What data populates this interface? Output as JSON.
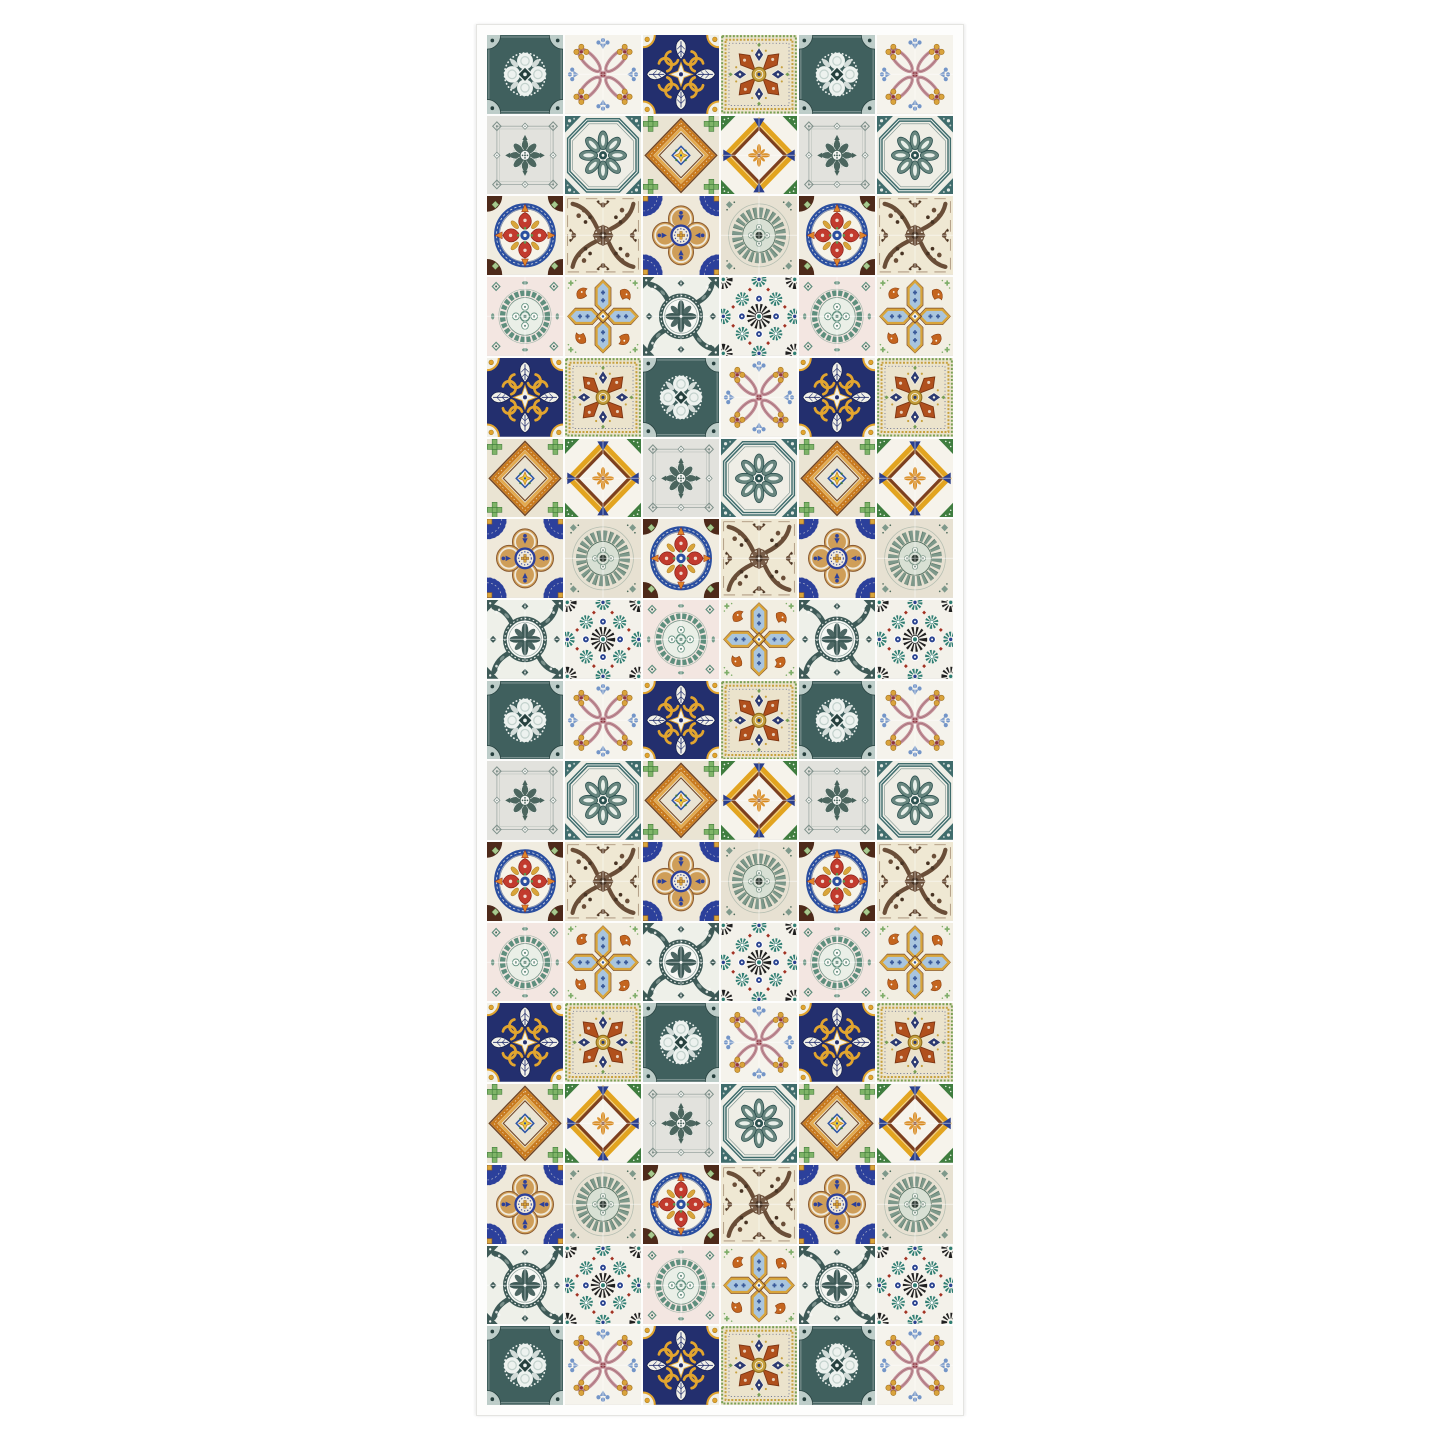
{
  "page": {
    "background_color": "#ffffff"
  },
  "poster": {
    "title": "Patchwork azulejo tile panel",
    "rows": 17,
    "cols": 6,
    "sheet_color": "#fdfdfc",
    "edge_color": "#e4e4e1",
    "grout_color": "#ffffff"
  },
  "tiles": {
    "teal-rosette": {
      "name": "dark teal ornate rosette tile",
      "quad": false,
      "palette": {
        "bg": "#40605e",
        "ink": "#edf2ef",
        "mid": "#c3d2cd",
        "dark": "#26403e"
      }
    },
    "pink-loops": {
      "name": "pink interlaced loops with gold flowers tile",
      "quad": true,
      "palette": {
        "bg": "#f5f3ec",
        "loop": "#c38f98",
        "loop_dark": "#9e6a74",
        "gold": "#daa33c",
        "gold_dark": "#a3731f",
        "blue": "#7395c8",
        "red": "#8e3540"
      }
    },
    "navy-gold-cross": {
      "name": "navy and gold scroll cross tile",
      "quad": false,
      "palette": {
        "navy": "#232f6e",
        "navy_dark": "#141e4d",
        "gold": "#e2a52f",
        "gold_dark": "#a87818",
        "ink": "#f1f0e8"
      }
    },
    "orange-star-mosaic": {
      "name": "rust star on mosaic-dot ground tile",
      "quad": false,
      "palette": {
        "bg": "#ebe3cc",
        "rust": "#b0501d",
        "rust_dark": "#7e3512",
        "navy": "#2c3a72",
        "gold": "#c6a03d",
        "gold_dark": "#8f6d1d",
        "green": "#79a054",
        "ink": "#f4f0e2"
      }
    },
    "gray-lace": {
      "name": "pale gray tile with fine green-gray medallion",
      "quad": false,
      "palette": {
        "bg": "#e2e2dd",
        "frame": "#a9b1ad",
        "orn": "#7e908a",
        "dark": "#46615a",
        "mid_bg": "#ccd2cb",
        "ink": "#f4f5f2"
      }
    },
    "teal-octagon": {
      "name": "teal octagon with eight-petal rosette tile",
      "quad": false,
      "palette": {
        "bg": "#efeee6",
        "teal": "#3f6c6c",
        "teal_dark": "#2c5150",
        "petal": "#68867f",
        "petal_lt": "#e9efe9",
        "ink": "#f7f7f2"
      }
    },
    "orange-diamond": {
      "name": "orange diamond frame with green crosses tile",
      "quad": false,
      "palette": {
        "bg": "#eae4d3",
        "or1": "#c87a1f",
        "or2": "#e2a94e",
        "brown": "#6f4527",
        "green": "#7fb468",
        "green_dark": "#3e7a39",
        "blue": "#2d55a5",
        "yellow": "#e9c93e",
        "ink": "#f4efdf"
      }
    },
    "orange-pinwheel": {
      "name": "orange and navy chevron star tile",
      "quad": true,
      "palette": {
        "bg": "#f6f3eb",
        "gold": "#e2a420",
        "brown": "#7c3f1f",
        "navy": "#2b3f8c",
        "green": "#3f7d3f",
        "orange": "#d8891e"
      }
    },
    "red-quatrefoil": {
      "name": "red quatrefoil in blue ring tile",
      "quad": false,
      "palette": {
        "bg": "#f0ece0",
        "blue": "#2b4fa0",
        "blue_dark": "#1d3572",
        "red": "#c23b2e",
        "red_dark": "#8a241c",
        "orange": "#e0862a",
        "green": "#5d9950",
        "brown": "#4e2a1a",
        "gold": "#d9a53a",
        "gold_dark": "#a3731f",
        "ltgreen": "#a9c88f",
        "ink": "#f6f3e8"
      }
    },
    "brown-damask": {
      "name": "sepia floral damask tile",
      "quad": true,
      "palette": {
        "bg": "#efe8d3",
        "sepia": "#6a4e38",
        "sepia_dk": "#483424",
        "line": "#8d7158",
        "ink": "#f6f1e2"
      }
    },
    "blue-gold-quatrefoil": {
      "name": "royal blue and tan quatrefoil tile",
      "quad": false,
      "palette": {
        "cream": "#efe9da",
        "blue": "#2c409b",
        "tan": "#cf9e58",
        "brown": "#8a5a30",
        "gold": "#d9a53a"
      }
    },
    "sage-circle": {
      "name": "sage green radial fan medallion tile",
      "quad": true,
      "palette": {
        "bg": "#e7e1d2",
        "sage": "#7e998b",
        "sage_dk": "#4d6a5b",
        "lt": "#d8e0d4",
        "ring": "#b3bdb0",
        "ink": "#2e3a33"
      }
    },
    "green-medallion": {
      "name": "teal scalloped wreath on pink tile",
      "quad": true,
      "palette": {
        "bg": "#f3e6e1",
        "teal": "#5f8f7e",
        "teal_dk": "#3c695a",
        "lt": "#e9f0e8",
        "ink": "#fbfbf7"
      }
    },
    "orange-cross-hex": {
      "name": "hexagon-arm cross with rust griffins tile",
      "quad": false,
      "palette": {
        "bg": "#f2eee2",
        "gold": "#d9a53a",
        "brown": "#7a4a28",
        "bluefill": "#a9c5de",
        "blue_dk": "#3a5a9a",
        "rust": "#c4651f",
        "rust_dk": "#8f4312",
        "green": "#7fae6a",
        "ink": "#f8f5ea"
      }
    },
    "teal-ornate-circle": {
      "name": "slate ornate circle medallion tile",
      "quad": true,
      "palette": {
        "bg": "#eef0e9",
        "slate": "#3e5a57",
        "slate_lt": "#7b918c",
        "ink": "#f7f8f4"
      }
    },
    "moorish-mosaic": {
      "name": "moorish geometric mosaic tile",
      "quad": false,
      "palette": {
        "bg": "#f3f1ea",
        "black": "#202020",
        "teal": "#2e7d72",
        "navy": "#2a4390",
        "red": "#a23122",
        "ink": "#ffffff"
      }
    }
  },
  "grid": {
    "rows": [
      [
        "teal-rosette",
        "pink-loops",
        "navy-gold-cross",
        "orange-star-mosaic",
        "teal-rosette",
        "pink-loops"
      ],
      [
        "gray-lace",
        "teal-octagon",
        "orange-diamond",
        "orange-pinwheel",
        "gray-lace",
        "teal-octagon"
      ],
      [
        "red-quatrefoil",
        "brown-damask",
        "blue-gold-quatrefoil",
        "sage-circle",
        "red-quatrefoil",
        "brown-damask"
      ],
      [
        "green-medallion",
        "orange-cross-hex",
        "teal-ornate-circle",
        "moorish-mosaic",
        "green-medallion",
        "orange-cross-hex"
      ],
      [
        "navy-gold-cross",
        "orange-star-mosaic",
        "teal-rosette",
        "pink-loops",
        "navy-gold-cross",
        "orange-star-mosaic"
      ],
      [
        "orange-diamond",
        "orange-pinwheel",
        "gray-lace",
        "teal-octagon",
        "orange-diamond",
        "orange-pinwheel"
      ],
      [
        "blue-gold-quatrefoil",
        "sage-circle",
        "red-quatrefoil",
        "brown-damask",
        "blue-gold-quatrefoil",
        "sage-circle"
      ],
      [
        "teal-ornate-circle",
        "moorish-mosaic",
        "green-medallion",
        "orange-cross-hex",
        "teal-ornate-circle",
        "moorish-mosaic"
      ],
      [
        "teal-rosette",
        "pink-loops",
        "navy-gold-cross",
        "orange-star-mosaic",
        "teal-rosette",
        "pink-loops"
      ],
      [
        "gray-lace",
        "teal-octagon",
        "orange-diamond",
        "orange-pinwheel",
        "gray-lace",
        "teal-octagon"
      ],
      [
        "red-quatrefoil",
        "brown-damask",
        "blue-gold-quatrefoil",
        "sage-circle",
        "red-quatrefoil",
        "brown-damask"
      ],
      [
        "green-medallion",
        "orange-cross-hex",
        "teal-ornate-circle",
        "moorish-mosaic",
        "green-medallion",
        "orange-cross-hex"
      ],
      [
        "navy-gold-cross",
        "orange-star-mosaic",
        "teal-rosette",
        "pink-loops",
        "navy-gold-cross",
        "orange-star-mosaic"
      ],
      [
        "orange-diamond",
        "orange-pinwheel",
        "gray-lace",
        "teal-octagon",
        "orange-diamond",
        "orange-pinwheel"
      ],
      [
        "blue-gold-quatrefoil",
        "sage-circle",
        "red-quatrefoil",
        "brown-damask",
        "blue-gold-quatrefoil",
        "sage-circle"
      ],
      [
        "teal-ornate-circle",
        "moorish-mosaic",
        "green-medallion",
        "orange-cross-hex",
        "teal-ornate-circle",
        "moorish-mosaic"
      ],
      [
        "teal-rosette",
        "pink-loops",
        "navy-gold-cross",
        "orange-star-mosaic",
        "teal-rosette",
        "pink-loops"
      ]
    ]
  }
}
